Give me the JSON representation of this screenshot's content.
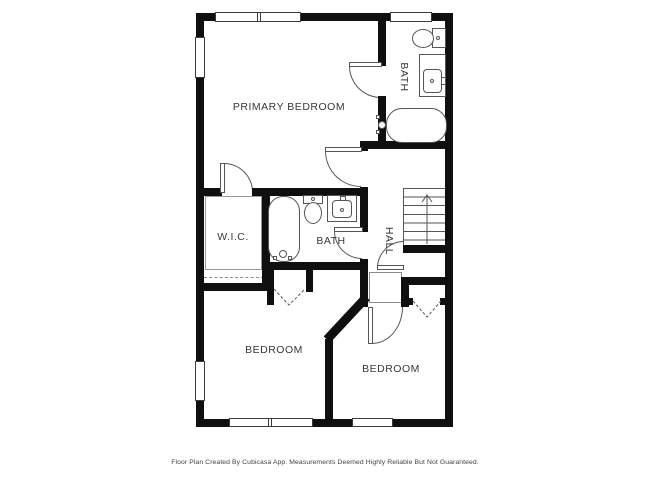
{
  "floor_plan": {
    "rooms": [
      {
        "id": "primary-bedroom",
        "label": "PRIMARY BEDROOM"
      },
      {
        "id": "bath-upper",
        "label": "BATH"
      },
      {
        "id": "wic",
        "label": "W.I.C."
      },
      {
        "id": "bath-middle",
        "label": "BATH"
      },
      {
        "id": "hall",
        "label": "HALL"
      },
      {
        "id": "bedroom-left",
        "label": "BEDROOM"
      },
      {
        "id": "bedroom-right",
        "label": "BEDROOM"
      }
    ],
    "icons": [
      {
        "name": "toilet-icon"
      },
      {
        "name": "sink-vanity-icon"
      },
      {
        "name": "bathtub-icon"
      },
      {
        "name": "stairs-up-icon"
      },
      {
        "name": "door-swing-icon"
      },
      {
        "name": "bifold-door-icon"
      },
      {
        "name": "window-icon"
      }
    ],
    "footer": "Floor Plan Created By Cubicasa App. Measurements Deemed Highly Reliable But Not Guaranteed.",
    "colors": {
      "wall": "#0f0f0f",
      "fixture_line": "#565656",
      "label_text": "#383838",
      "background": "#ffffff"
    }
  }
}
